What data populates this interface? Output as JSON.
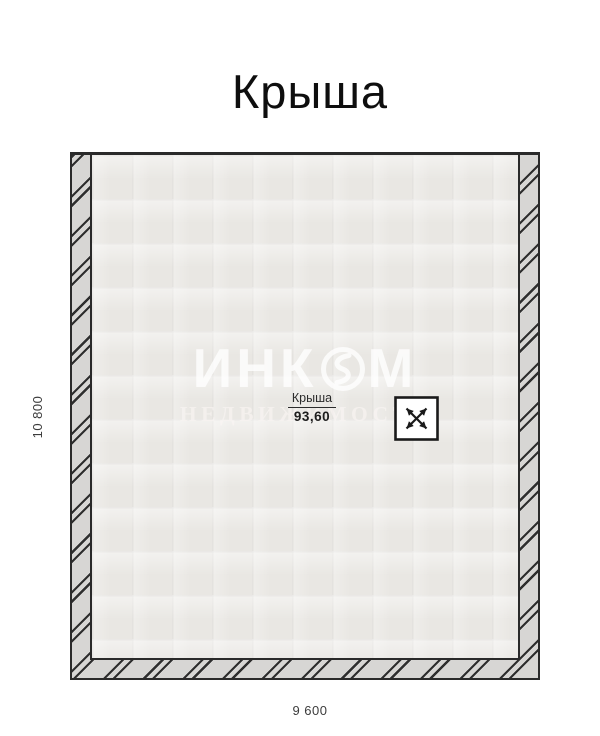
{
  "page": {
    "title": "Крыша"
  },
  "plan": {
    "room": {
      "name": "Крыша",
      "area": "93,60"
    },
    "dimensions": {
      "left": "10 800",
      "bottom": "9 600"
    },
    "watermark": {
      "brand_left": "ИНК",
      "brand_right": "М",
      "subtitle": "НЕДВИЖИМОСТЬ"
    },
    "icons": {
      "logo": "incom-logo-icon",
      "roof_hatch": "roof-hatch-icon"
    },
    "colors": {
      "wall_fill": "#d7d6d4",
      "hatch_line": "#2e2e2e",
      "interior_fill": "#e9e7e3",
      "outline": "#2a2a2a",
      "title_color": "#0e0e0e",
      "dimension_color": "#3c3c3c",
      "watermark_color": "rgba(255,255,255,0.78)"
    }
  }
}
